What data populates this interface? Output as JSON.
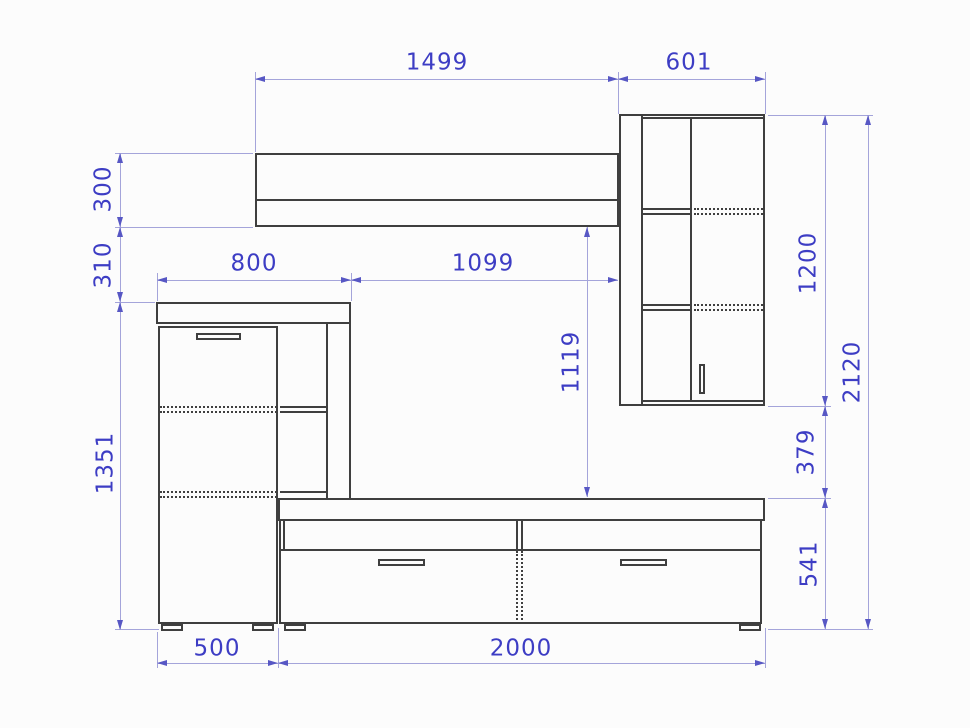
{
  "colors": {
    "background": "#fcfcfc",
    "furniture_line": "#3f3f3f",
    "dimension_line": "#a4a4da",
    "dimension_arrow": "#5757c4",
    "dimension_text": "#3d3dc4"
  },
  "dims": {
    "top_shelf_width": "1499",
    "wall_cabinet_width": "601",
    "top_shelf_height": "300",
    "shelf_to_left_cabinet_gap": "310",
    "left_cabinet_top_width": "800",
    "shelf_middle_span": "1099",
    "shelf_to_tv_stand": "1119",
    "wall_cabinet_height": "1200",
    "total_height": "2120",
    "left_cabinet_height": "1351",
    "wall_cabinet_to_stand_gap": "379",
    "tv_stand_height": "541",
    "left_cabinet_bottom_width": "500",
    "tv_stand_width": "2000"
  }
}
